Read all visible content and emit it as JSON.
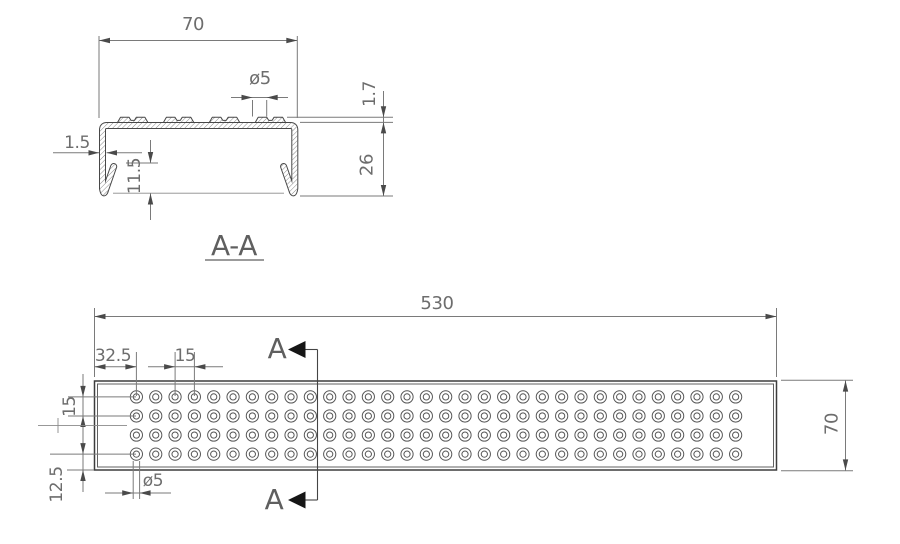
{
  "drawing": {
    "type": "engineering-drawing",
    "section_view": {
      "label": "A-A",
      "dims": {
        "width": "70",
        "hole_dia": "ø5",
        "rib_height": "1.7",
        "height": "26",
        "thickness": "1.5",
        "hem_height": "11.5"
      }
    },
    "plan_view": {
      "section_letter": "A",
      "dims": {
        "length": "530",
        "end_margin": "32.5",
        "hole_pitch": "15",
        "row_pitch": "15",
        "bottom_margin": "12.5",
        "hole_dia": "ø5",
        "width": "70"
      },
      "holes": {
        "rows": 4,
        "cols": 32
      }
    },
    "colors": {
      "line": "#474747",
      "dimension": "#7a7a7a",
      "text": "#6d6d6d",
      "hatch": "#757575",
      "section_arrow": "#161616",
      "background": "#ffffff"
    }
  }
}
